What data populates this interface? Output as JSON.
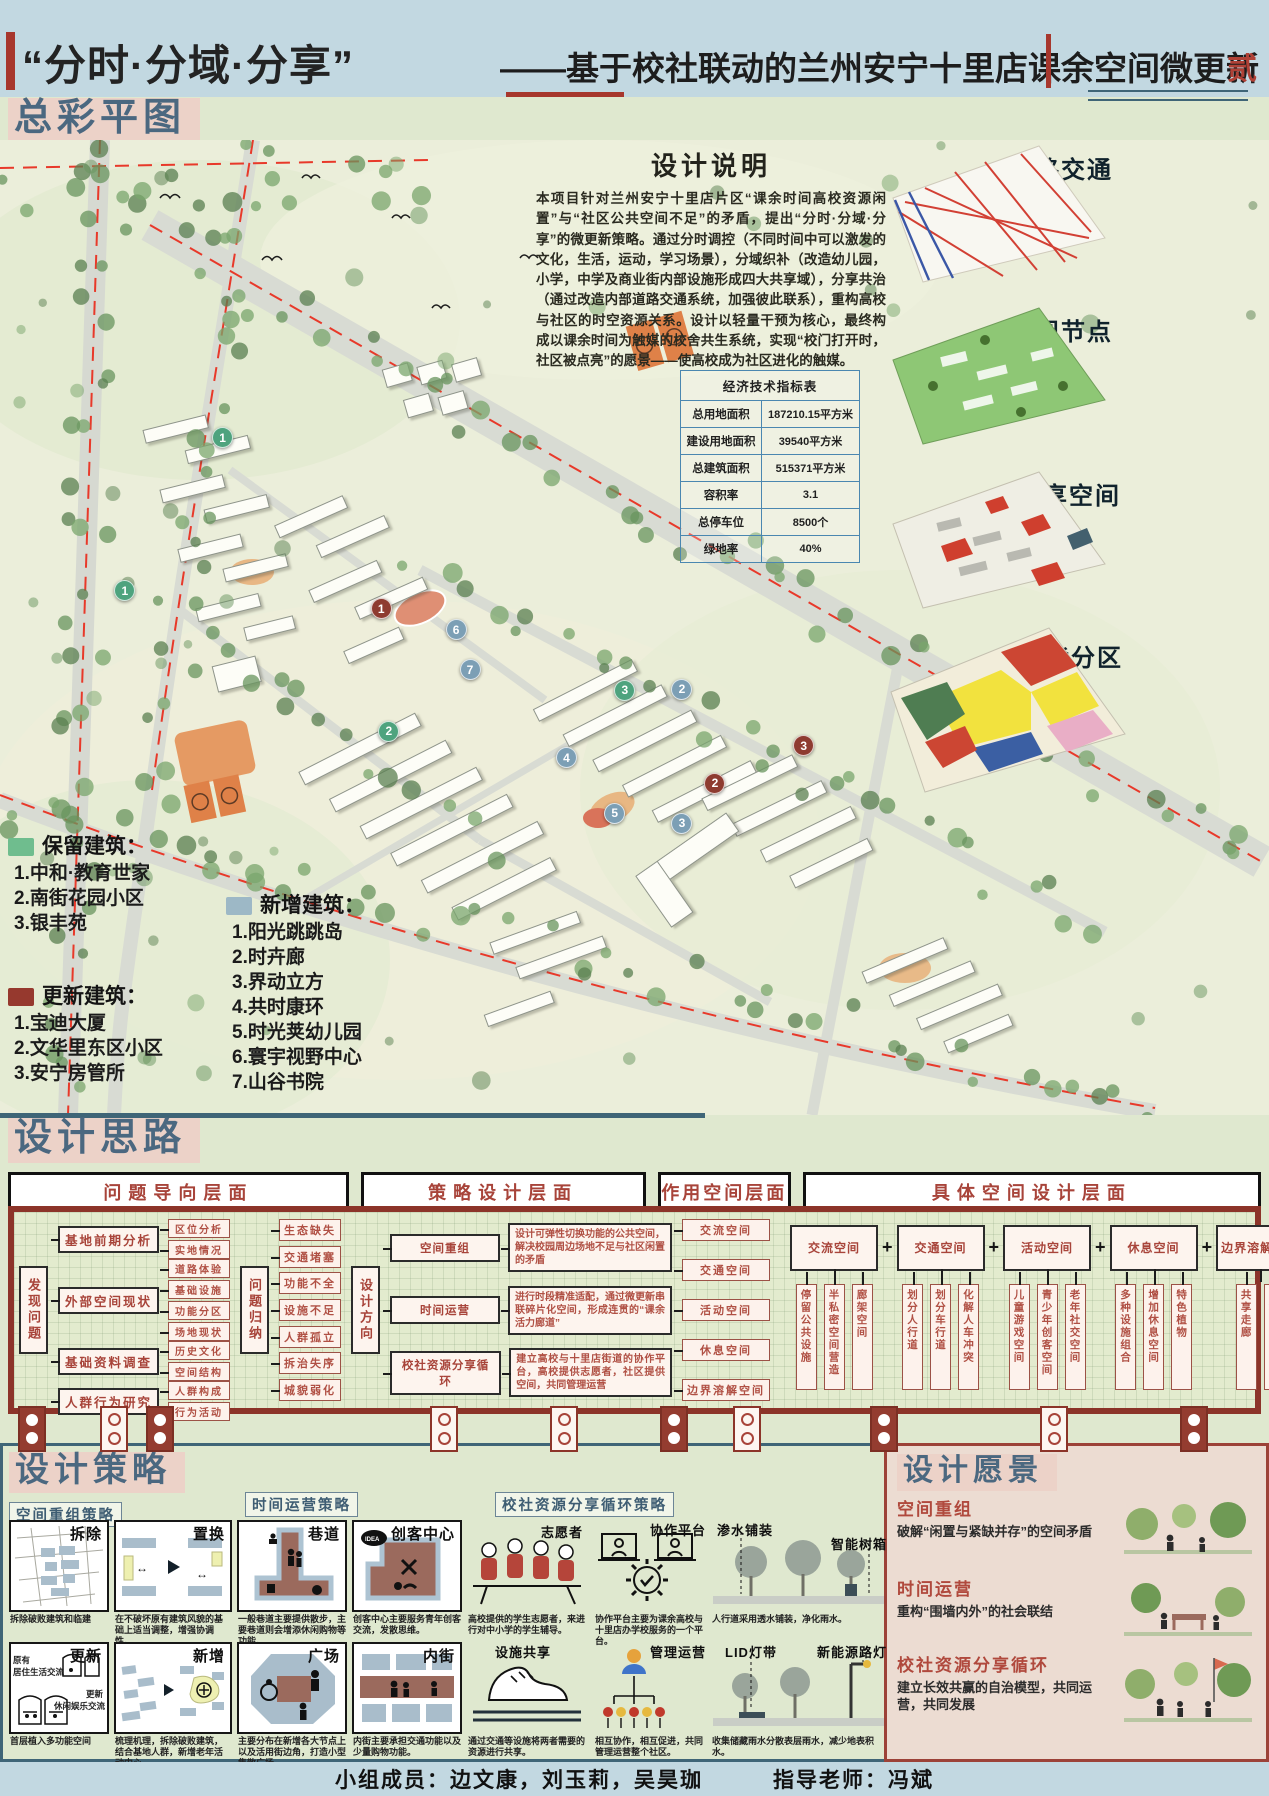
{
  "page": {
    "number_badge": "贰"
  },
  "title": {
    "main": "“分时·分域·分享”",
    "sub": "——基于校社联动的兰州安宁十里店课余空间微更新"
  },
  "sections": {
    "plan": "总彩平图",
    "concept": "设计思路",
    "strategy": "设计策略",
    "vision": "设计愿景"
  },
  "colors": {
    "accent_red": "#a7372d",
    "slate": "#4b6880",
    "panel_pink": "#ecd2c8",
    "retain": "#4ea37e",
    "new": "#7c9fb5",
    "renew": "#8e3b30"
  },
  "plan": {
    "description": {
      "title": "设计说明",
      "body": "本项目针对兰州安宁十里店片区“课余时间高校资源闲置”与“社区公共空间不足”的矛盾，提出“分时·分域·分享”的微更新策略。通过分时调控（不同时间中可以激发的文化，生活，运动，学习场景），分域织补（改造幼儿园，小学，中学及商业街内部设施形成四大共享域），分享共治（通过改造内部道路交通系统，加强彼此联系），重构高校与社区的时空资源关系。设计以轻量干预为核心，最终构成以课余时间为触媒的校舍共生系统，实现“校门打开时，社区被点亮”的愿景——使高校成为社区进化的触媒。"
    },
    "table": {
      "title": "经济技术指标表",
      "rows": [
        [
          "总用地面积",
          "187210.15平方米"
        ],
        [
          "建设用地面积",
          "39540平方米"
        ],
        [
          "总建筑面积",
          "515371平方米"
        ],
        [
          "容积率",
          "3.1"
        ],
        [
          "总停车位",
          "8500个"
        ],
        [
          "绿地率",
          "40%"
        ]
      ]
    },
    "thumbnails": [
      {
        "label": "道路交通"
      },
      {
        "label": "景观节点"
      },
      {
        "label": "共享空间"
      },
      {
        "label": "功能分区"
      }
    ],
    "legend": {
      "retain": {
        "title": "保留建筑：",
        "color": "#6fbd8e",
        "items": [
          "1.中和·教育世家",
          "2.南街花园小区",
          "3.银丰苑"
        ]
      },
      "new": {
        "title": "新增建筑：",
        "color": "#9db8c6",
        "items": [
          "1.阳光跳跳岛",
          "2.时卉廊",
          "3.界动立方",
          "4.共时康环",
          "5.时光荚幼儿园",
          "6.寰宇视野中心",
          "7.山谷书院"
        ]
      },
      "renew": {
        "title": "更新建筑：",
        "color": "#96392e",
        "items": [
          "1.宝迪大厦",
          "2.文华里东区小区",
          "3.安宁房管所"
        ]
      }
    },
    "markers": [
      {
        "type": "retain",
        "label": "1",
        "x": 17.5,
        "y": 30.5
      },
      {
        "type": "retain",
        "label": "1",
        "x": 9.8,
        "y": 46.2
      },
      {
        "type": "renew",
        "label": "1",
        "x": 30.0,
        "y": 48.0
      },
      {
        "type": "new",
        "label": "6",
        "x": 35.9,
        "y": 50.2
      },
      {
        "type": "new",
        "label": "7",
        "x": 37.0,
        "y": 54.3
      },
      {
        "type": "retain",
        "label": "2",
        "x": 30.6,
        "y": 60.6
      },
      {
        "type": "retain",
        "label": "3",
        "x": 49.2,
        "y": 56.4
      },
      {
        "type": "new",
        "label": "2",
        "x": 53.7,
        "y": 56.3
      },
      {
        "type": "new",
        "label": "4",
        "x": 44.6,
        "y": 63.3
      },
      {
        "type": "renew",
        "label": "3",
        "x": 63.3,
        "y": 62.1
      },
      {
        "type": "renew",
        "label": "2",
        "x": 56.3,
        "y": 65.9
      },
      {
        "type": "new",
        "label": "5",
        "x": 48.4,
        "y": 69.0
      },
      {
        "type": "new",
        "label": "3",
        "x": 53.7,
        "y": 70.0
      }
    ]
  },
  "flow": {
    "headers": [
      "问题导向层面",
      "策略设计层面",
      "作用空间层面",
      "具体空间设计层面"
    ],
    "discover": "发现问题",
    "groups": [
      {
        "label": "基地前期分析",
        "children": [
          "区位分析",
          "实地情况"
        ]
      },
      {
        "label": "外部空间现状",
        "children": [
          "道路体验",
          "基础设施",
          "功能分区",
          "场地现状"
        ]
      },
      {
        "label": "基础资料调查",
        "children": [
          "历史文化",
          "空间结构"
        ]
      },
      {
        "label": "人群行为研究",
        "children": [
          "人群构成",
          "行为活动"
        ]
      }
    ],
    "summarize": "问题归纳",
    "problems": [
      "生态缺失",
      "交通堵塞",
      "功能不全",
      "设施不足",
      "人群孤立",
      "拆治失序",
      "城貌弱化"
    ],
    "direction": "设计方向",
    "strategies": [
      {
        "label": "空间重组",
        "desc": "设计可弹性切换功能的公共空间，解决校园周边场地不足与社区闲置的矛盾"
      },
      {
        "label": "时间运营",
        "desc": "进行时段精准适配，通过微更新串联碎片化空间，形成连贯的“课余活力廊道”"
      },
      {
        "label": "校社资源分享循环",
        "desc": "建立高校与十里店街道的协作平台，高校提供志愿者，社区提供空间，共同管理运营"
      }
    ],
    "spaces": [
      "交流空间",
      "交通空间",
      "活动空间",
      "休息空间",
      "边界溶解空间"
    ],
    "plus": "+",
    "families": [
      {
        "label": "交流空间",
        "children": [
          "停留公共设施",
          "半私密空间营造",
          "廊架空间"
        ]
      },
      {
        "label": "交通空间",
        "children": [
          "划分人行道",
          "划分车行道",
          "化解人车冲突"
        ]
      },
      {
        "label": "活动空间",
        "children": [
          "儿童游戏空间",
          "青少年创客空间",
          "老年社交空间"
        ]
      },
      {
        "label": "休息空间",
        "children": [
          "多种设施组合",
          "增加休息空间",
          "特色植物"
        ]
      },
      {
        "label": "边界溶解空间",
        "children": [
          "共享走廊",
          "口袋广场"
        ]
      }
    ]
  },
  "strategy": {
    "sub1": "空间重组策略",
    "sub2": "时间运营策略",
    "sub3": "校社资源分享循环策略",
    "cards": [
      {
        "title": "拆除",
        "caption": "拆除破败建筑和临建"
      },
      {
        "title": "置换",
        "caption": "在不破坏原有建筑风貌的基础上适当调整，增强协调性。"
      },
      {
        "title": "巷道",
        "caption": "一般巷道主要提供散步，主要巷道则会增添休闲购物等功能。"
      },
      {
        "title": "创客中心",
        "caption": "创客中心主要服务青年创客交流，发散思维。"
      },
      {
        "title": "更新",
        "caption": "首层植入多功能空间",
        "annotations": [
          "原有",
          "居住生活交流",
          "更新",
          "休闲娱乐交流"
        ]
      },
      {
        "title": "新增",
        "caption": "梳理机理，拆除破败建筑，结合基地人群，新增老年活动中心。"
      },
      {
        "title": "广场",
        "caption": "主要分布在新增各大节点上以及活用街边角，打造小型集散广场。"
      },
      {
        "title": "内街",
        "caption": "内街主要承担交通功能以及少量购物功能。"
      }
    ],
    "share": {
      "volunteer": {
        "label": "志愿者",
        "caption": "高校提供的学生志愿者，来进行对中小学的学生辅导。"
      },
      "platform": {
        "label": "协作平台",
        "caption": "协作平台主要为课余高校与十里店办学校服务的一个平台。"
      },
      "facility": {
        "label": "设施共享",
        "caption": "通过交通等设施将两者需要的资源进行共享。"
      },
      "management": {
        "label": "管理运营",
        "caption": "相互协作，相互促进，共同管理运营整个社区。"
      }
    },
    "street": {
      "permeable": {
        "label": "渗水铺装",
        "caption": "人行道采用透水铺装，净化雨水。"
      },
      "treebox": {
        "label": "智能树箱",
        "caption": "及时检测树木生长情况，保持树木各项设施稳定。"
      },
      "lid": {
        "label": "LID灯带",
        "caption": "收集储藏雨水分散表层雨水，减少地表积水。"
      },
      "solar": {
        "label": "新能源路灯",
        "caption": "城市路灯采用太阳能、风能等新能源发电，低碳环保。"
      }
    }
  },
  "vision": {
    "items": [
      {
        "label": "空间重组",
        "desc": "破解“闲置与紧缺并存”的空间矛盾"
      },
      {
        "label": "时间运营",
        "desc": "重构“围墙内外”的社会联结"
      },
      {
        "label": "校社资源分享循环",
        "desc": "建立长效共赢的自治模型，共同运营，共同发展"
      }
    ]
  },
  "footer": {
    "members": "小组成员：边文康，刘玉莉，吴昊珈",
    "advisor": "指导老师：冯斌"
  }
}
